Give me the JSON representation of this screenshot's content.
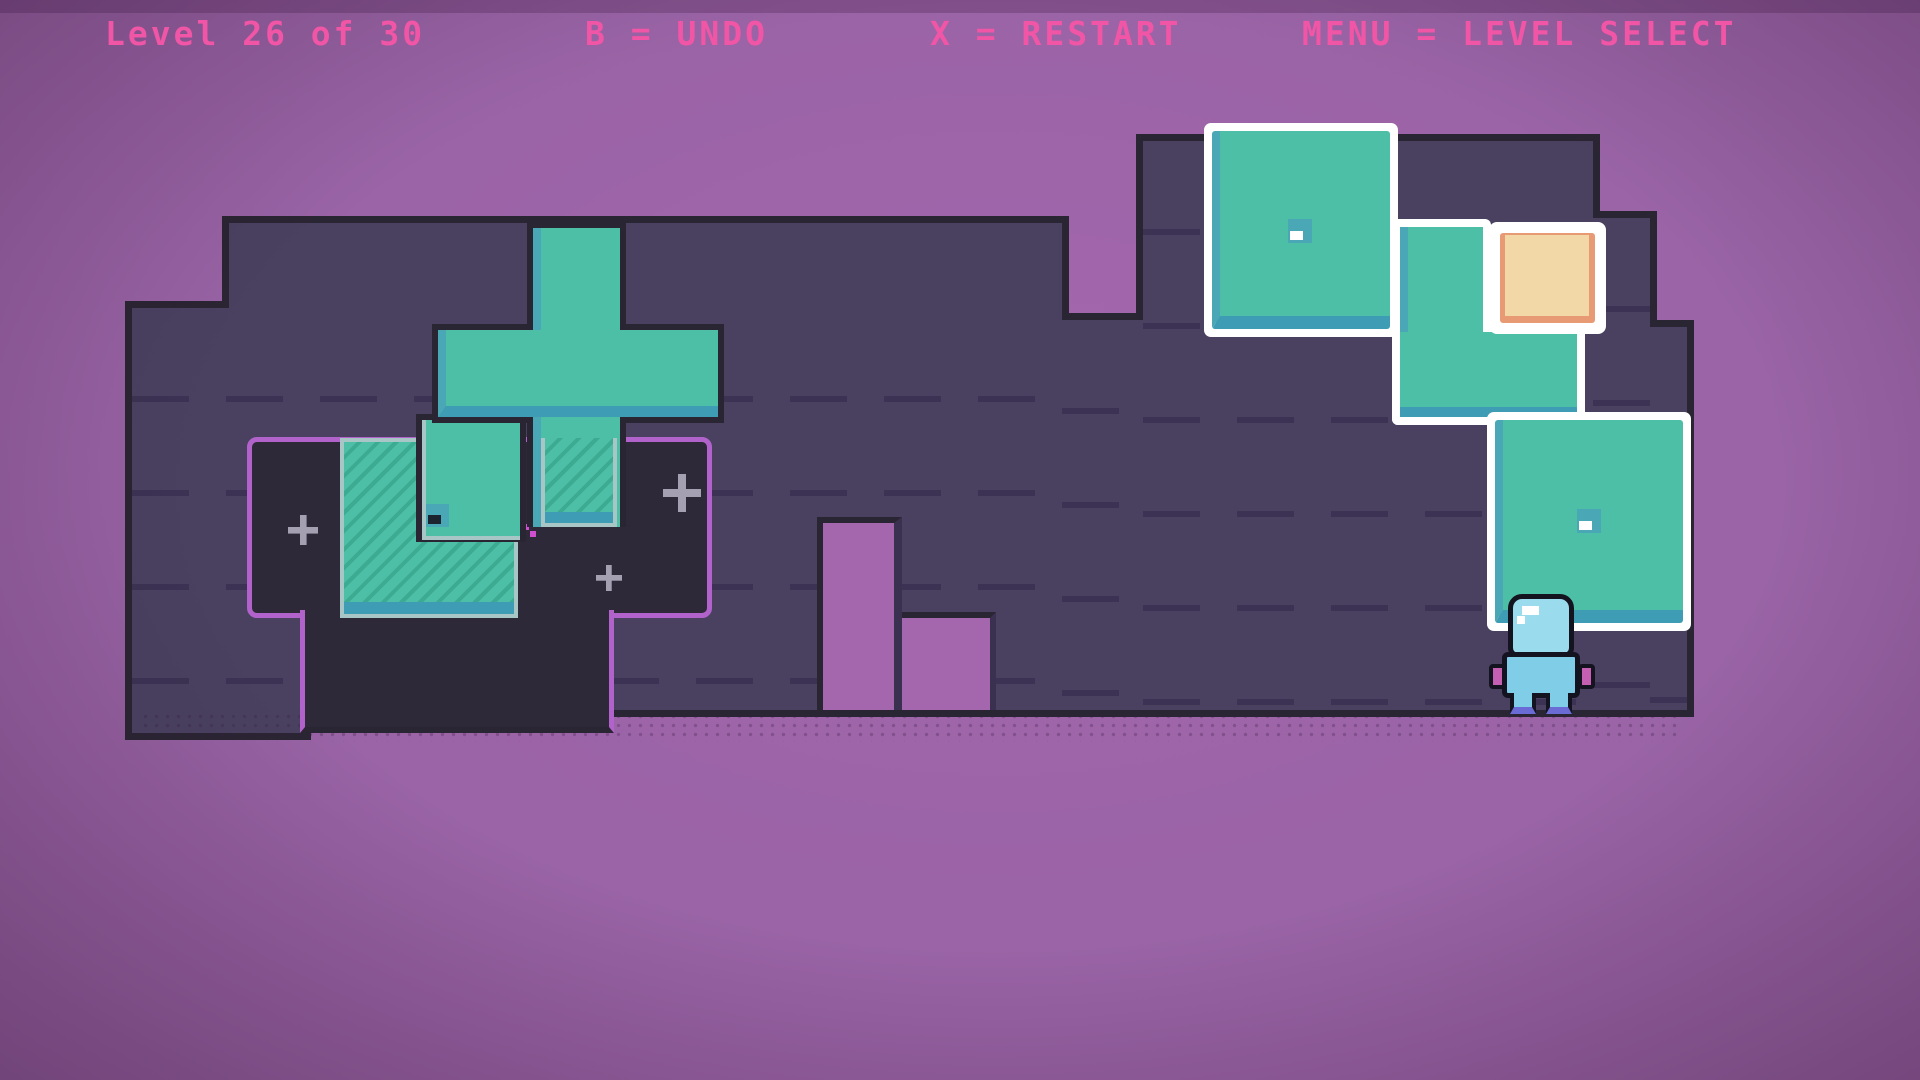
{
  "hud": {
    "level": "Level 26 of 30",
    "undo": "B = UNDO",
    "restart": "X = RESTART",
    "menu": "MENU = LEVEL SELECT"
  },
  "scene": {
    "player": "blue-astronaut",
    "sparkle_count": 3,
    "blocks": [
      "cross-block",
      "small-eye-block",
      "large-eye-block",
      "l-block",
      "orange-block",
      "square-eye-block"
    ],
    "targets": [
      "hatched-target-2x2",
      "hatched-target-under-cross"
    ]
  },
  "colors": {
    "bg": "#9a64a6",
    "bgBright": "#a466ad",
    "outline": "#2a2533",
    "floor": "#4a4161",
    "floorDash": "#3c3354",
    "pit": "#2e2939",
    "pitBorder": "#b163cb",
    "teal": "#4cbfa6",
    "tealHatch": "#3cab92",
    "tealSide": "#4aa7b5",
    "tealShade": "#3e9cb5",
    "targetBorder": "#a9c6c6",
    "white": "#ffffff",
    "peach": "#f2d7a7",
    "peachEdge": "#e89a74",
    "pink": "#f155a5",
    "sparkle": "#b9b4c6",
    "magentaDot": "#cf4fd0",
    "charLight": "#9adced",
    "charMid": "#7fcde6",
    "charHand": "#c45fb2",
    "charBoot": "#6b6bd6",
    "charOutline": "#141420"
  }
}
